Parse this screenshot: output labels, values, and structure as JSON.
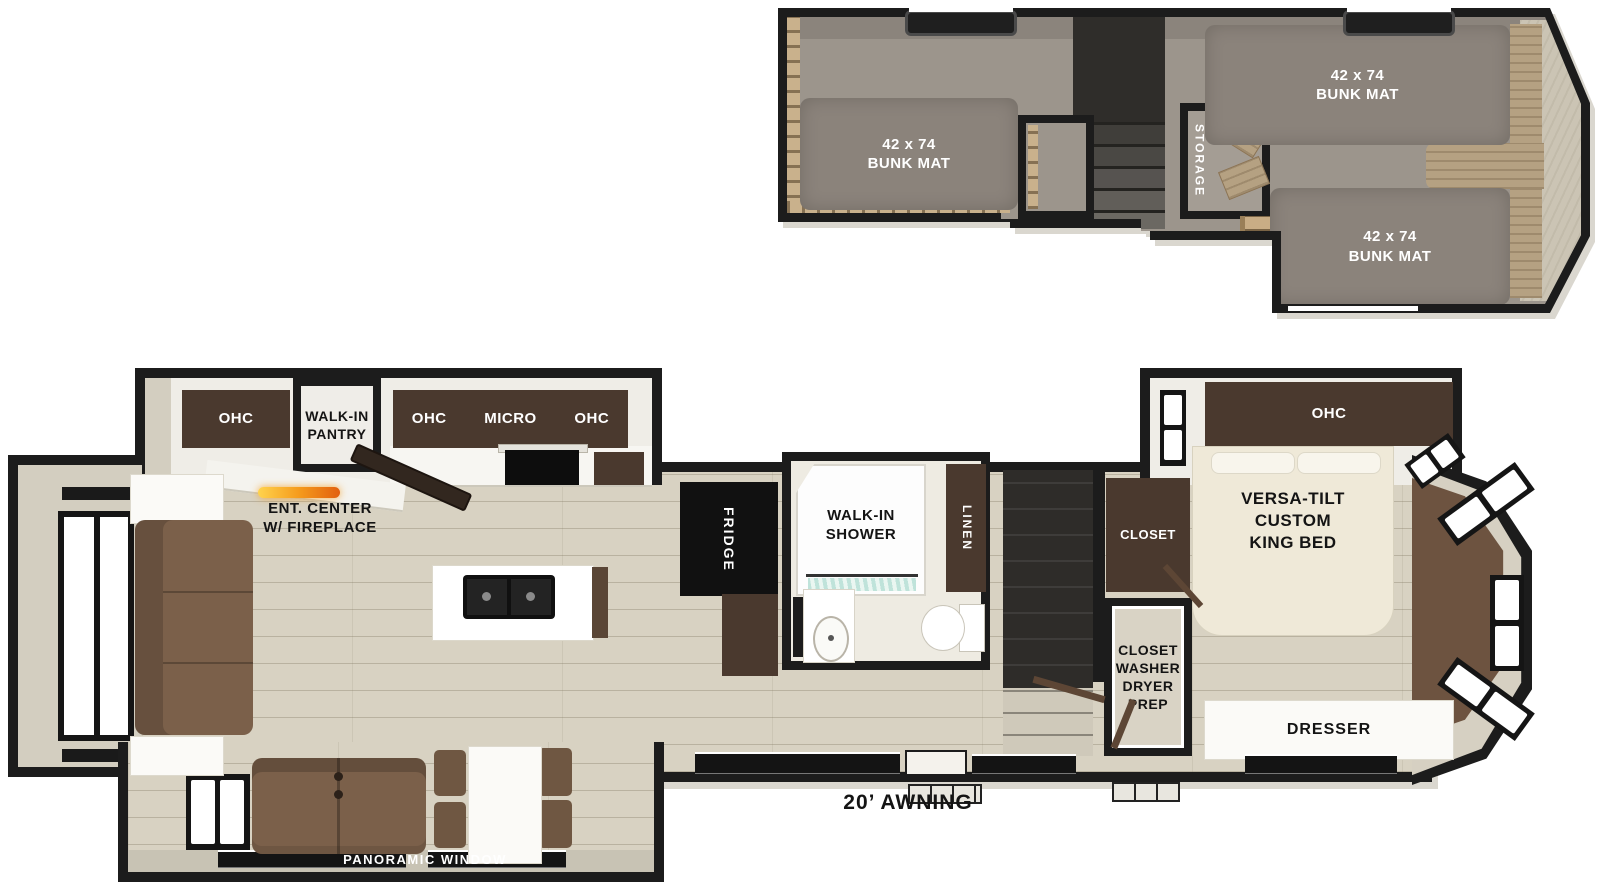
{
  "loft": {
    "bunk_left": "42 x 74\nBUNK MAT",
    "bunk_top_right": "42 x 74\nBUNK MAT",
    "bunk_bottom_right": "42 x 74\nBUNK MAT",
    "storage_label": "STORAGE"
  },
  "kitchen": {
    "ohc_left_label": "OHC",
    "pantry_label": "WALK-IN\nPANTRY",
    "ohc_mid_label": "OHC",
    "micro_label": "MICRO",
    "ohc_right_label": "OHC",
    "ent_center_label": "ENT. CENTER\nW/ FIREPLACE",
    "fridge_label": "FRIDGE"
  },
  "bathroom": {
    "shower_label": "WALK-IN\nSHOWER",
    "linen_label": "LINEN"
  },
  "bedroom": {
    "ohc_label": "OHC",
    "closet_label": "CLOSET",
    "washer_prep_label": "CLOSET\nWASHER\nDRYER\nPREP",
    "king_bed_label": "VERSA-TILT\nCUSTOM\nKING BED",
    "dresser_label": "DRESSER"
  },
  "exterior": {
    "awning_label": "20’ AWNING",
    "panoramic_window_label": "PANORAMIC WINDOW"
  },
  "colors": {
    "wall": "#1c1c1c",
    "floor": "#d8d2c2",
    "loft_carpet": "#9c958c",
    "cabinet": "#4a392e",
    "sofa": "#7b604a",
    "fireplace_accent": "#f59b1c",
    "wood_trim": "#c3aa84",
    "rear_carpet": "#6d5340"
  }
}
